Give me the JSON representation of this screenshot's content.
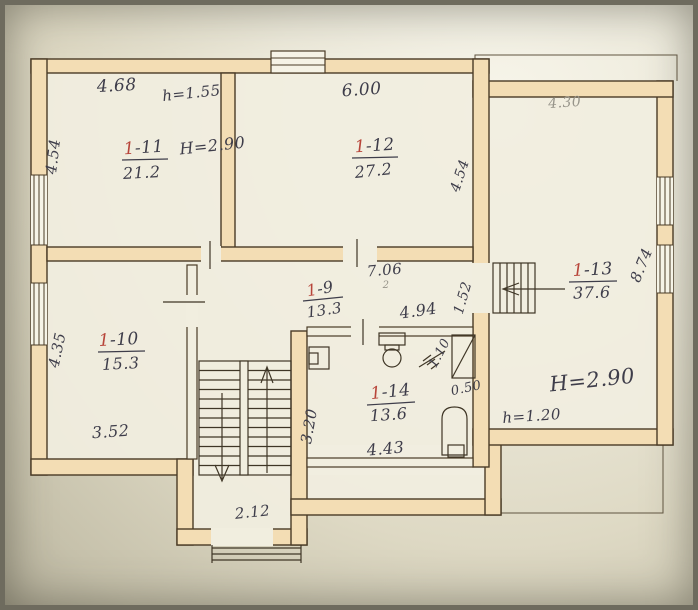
{
  "rooms": {
    "r9": {
      "number_red": "1",
      "number_rest": "-9",
      "area": "13.3"
    },
    "r10": {
      "number_red": "1",
      "number_rest": "-10",
      "area": "15.3"
    },
    "r11": {
      "number_red": "1",
      "number_rest": "-11",
      "area": "21.2"
    },
    "r12": {
      "number_red": "1",
      "number_rest": "-12",
      "area": "27.2"
    },
    "r13": {
      "number_red": "1",
      "number_rest": "-13",
      "area": "37.6"
    },
    "r14": {
      "number_red": "1",
      "number_rest": "-14",
      "area": "13.6"
    }
  },
  "dimensions": {
    "r11_width": "4.68",
    "r11_side": "4.54",
    "r11_lintel": "h=1.55",
    "r11_ceiling": "H=2.90",
    "r12_width": "6.00",
    "r12_side": "4.54",
    "r13_width": "4.30",
    "r13_side": "8.74",
    "r13_ceiling": "H=2.90",
    "r13_lintel": "h=1.20",
    "r10_side": "4.35",
    "r10_width": "3.52",
    "hall_width": "7.06",
    "hall_note": "2",
    "hall_inner": "4.94",
    "hall_passage": "1.52",
    "r14_side": "3.20",
    "r14_width": "4.43",
    "r14_sink": "0.50",
    "r14_tap": "1.10",
    "porch_width": "2.12"
  },
  "colors": {
    "paper": "#ece9d8",
    "wall_fill": "#f3ddb4",
    "wall_outline": "#4a3b26",
    "ink": "#3e3d4a",
    "room_number_red": "#b8453a"
  }
}
